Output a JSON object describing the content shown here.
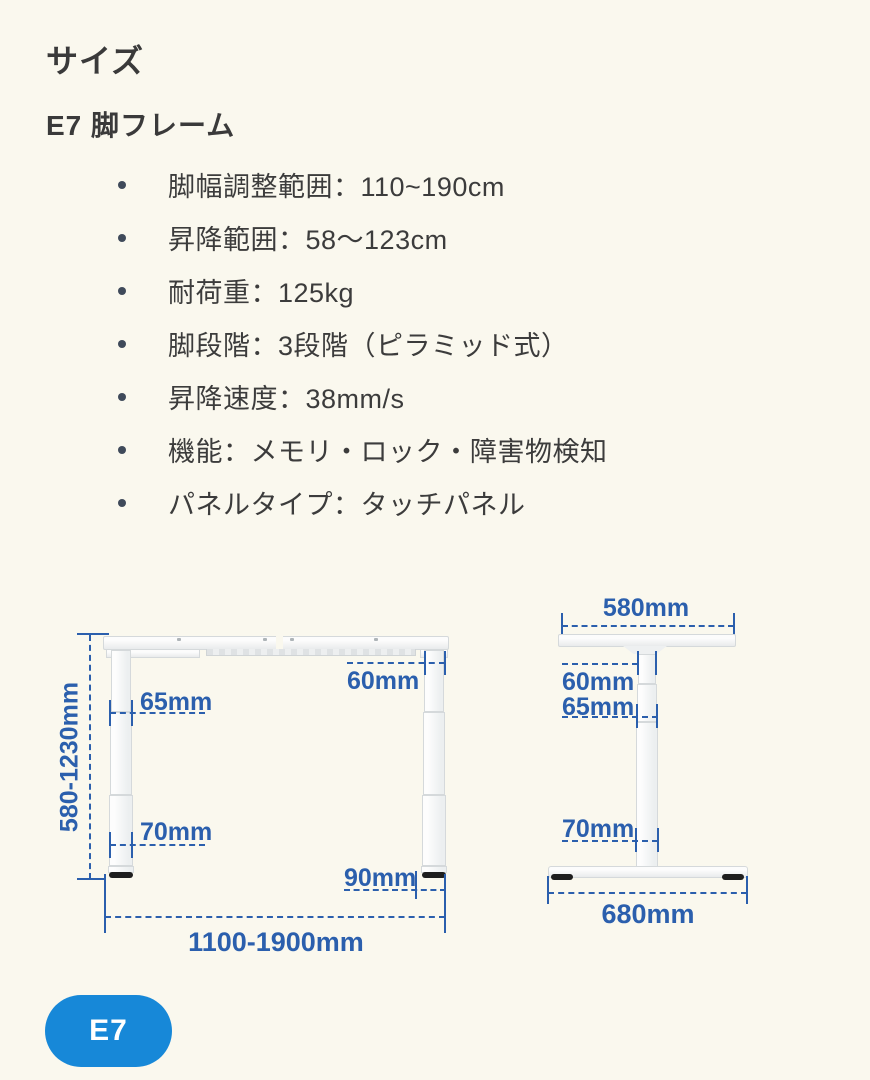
{
  "page": {
    "title": "サイズ",
    "subtitle": "E7 脚フレーム",
    "background_color": "#faf8ee",
    "text_color": "#3a3a3a"
  },
  "specs": [
    "脚幅調整範囲：110~190cm",
    "昇降範囲：58〜123cm",
    "耐荷重：125kg",
    "脚段階：3段階（ピラミッド式）",
    "昇降速度：38mm/s",
    "機能：メモリ・ロック・障害物検知",
    "パネルタイプ：タッチパネル"
  ],
  "diagram": {
    "dimension_color": "#2b5fad",
    "front_view": {
      "height_range": "580-1230mm",
      "upper_column_width": "60mm",
      "middle_column_width": "65mm",
      "lower_column_width": "70mm",
      "foot_overhang": "90mm",
      "width_range": "1100-1900mm"
    },
    "side_view": {
      "top_bracket_width": "580mm",
      "upper_column_depth": "60mm",
      "middle_column_depth": "65mm",
      "lower_column_depth": "70mm",
      "base_depth": "680mm"
    }
  },
  "badge": {
    "label": "E7",
    "background_color": "#1788d8"
  }
}
